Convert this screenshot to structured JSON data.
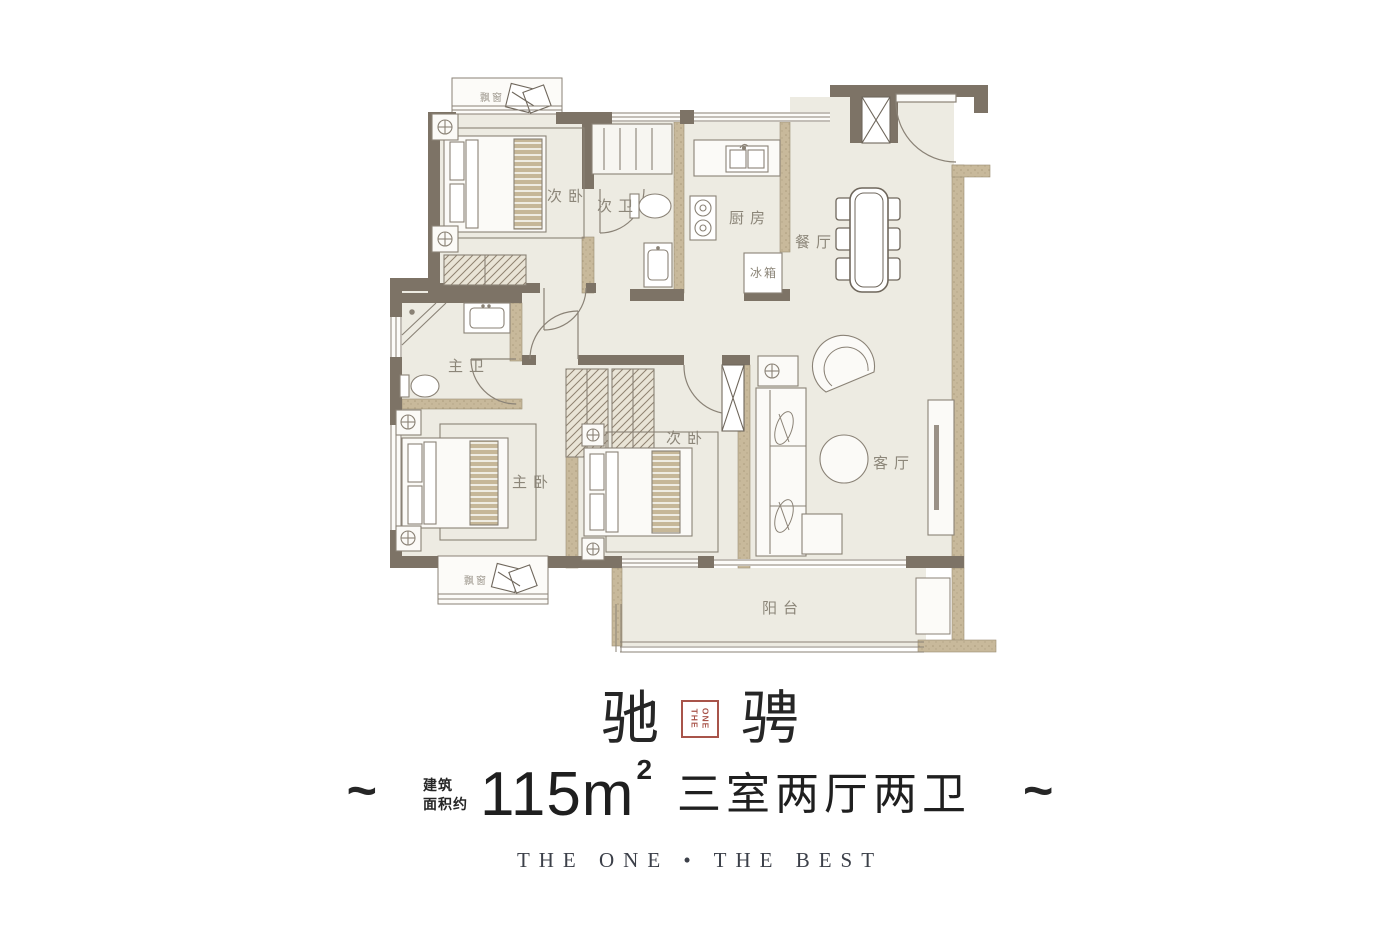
{
  "plan": {
    "labels": {
      "bay_window_top": "飘窗",
      "bedroom_second_top": "次卧",
      "bath_second": "次卫",
      "kitchen": "厨房",
      "fridge": "冰箱",
      "dining": "餐厅",
      "bath_master": "主卫",
      "bedroom_master": "主卧",
      "bedroom_second_bottom": "次卧",
      "living": "客厅",
      "balcony": "阳台",
      "bay_window_bottom": "飘窗"
    }
  },
  "footer": {
    "title_left": "驰",
    "title_right": "骋",
    "seal_lines": [
      "ONE",
      "THE"
    ],
    "tilde_left": "~",
    "tilde_right": "~",
    "area_label_line1": "建筑",
    "area_label_line2": "面积约",
    "area_number": "115",
    "area_unit": "m",
    "area_exponent": "2",
    "rooms_summary": "三室两厅两卫",
    "slogan": "THE ONE • THE BEST"
  },
  "colors": {
    "wall_dark": "#7d7366",
    "wall_light": "#c8b99b",
    "floor": "#edebe2",
    "furniture_line": "#8a8276",
    "label_gray": "#8c8679",
    "seal_red": "#a8544a",
    "slogan_gray": "#3c4049"
  }
}
